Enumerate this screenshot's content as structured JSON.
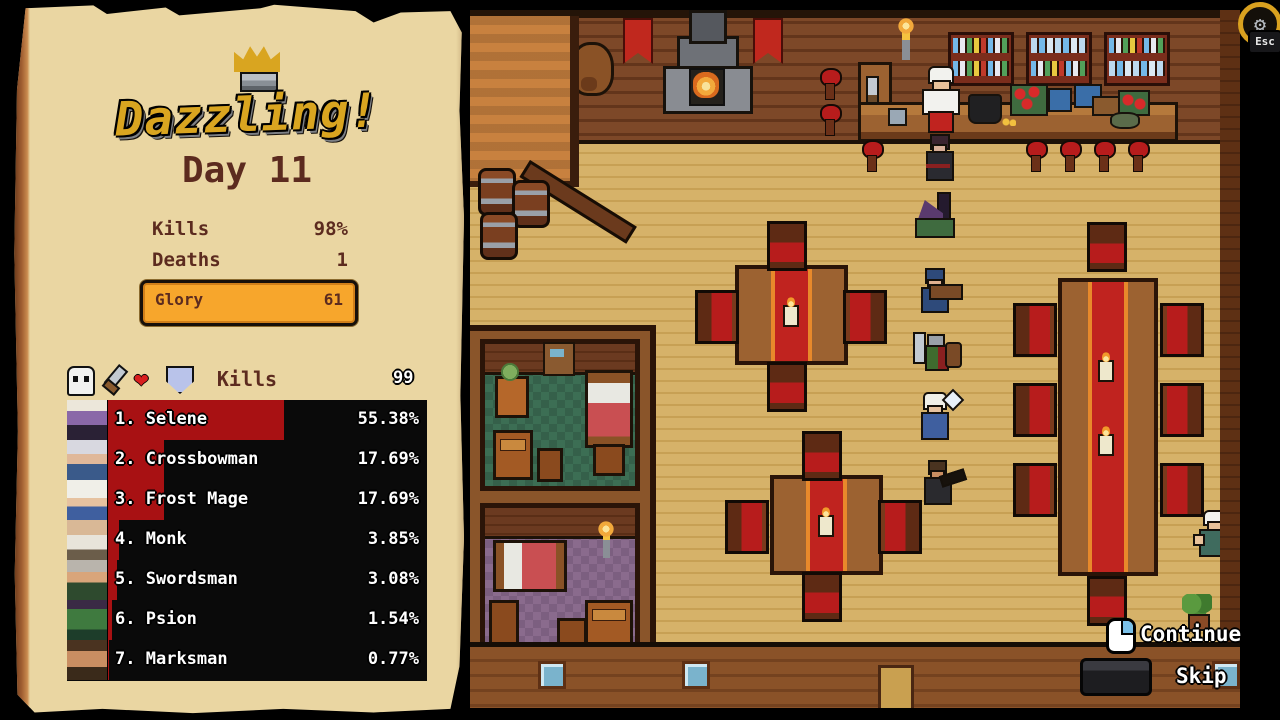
{
  "panel": {
    "logo": "Dazzling!",
    "day": "Day 11",
    "stats": [
      {
        "label": "Kills",
        "value": "98%"
      },
      {
        "label": "Deaths",
        "value": "1"
      },
      {
        "label": "Glory",
        "value": "61"
      }
    ],
    "leaderboard": {
      "column_title": "Kills",
      "max_value": "99",
      "icons": [
        "skull-icon",
        "sword-icon",
        "heart-icon",
        "shield-icon"
      ],
      "rows": [
        {
          "rank": "1.",
          "name": "Selene",
          "value": "55.38%",
          "bar_pct": 55.38
        },
        {
          "rank": "2.",
          "name": "Crossbowman",
          "value": "17.69%",
          "bar_pct": 17.69
        },
        {
          "rank": "3.",
          "name": "Frost Mage",
          "value": "17.69%",
          "bar_pct": 17.69
        },
        {
          "rank": "4.",
          "name": "Monk",
          "value": "3.85%",
          "bar_pct": 3.85
        },
        {
          "rank": "5.",
          "name": "Swordsman",
          "value": "3.08%",
          "bar_pct": 3.08
        },
        {
          "rank": "6.",
          "name": "Psion",
          "value": "1.54%",
          "bar_pct": 1.54
        },
        {
          "rank": "7.",
          "name": "Marksman",
          "value": "0.77%",
          "bar_pct": 0.77
        }
      ]
    }
  },
  "scene": {
    "continue_label": "Continue",
    "skip_label": "Skip",
    "esc_label": "Esc"
  },
  "colors": {
    "accent_orange": "#f7a62c",
    "bar_red": "#a81113",
    "parchment": "#ead6a2",
    "chair_red": "#b71c1c"
  }
}
